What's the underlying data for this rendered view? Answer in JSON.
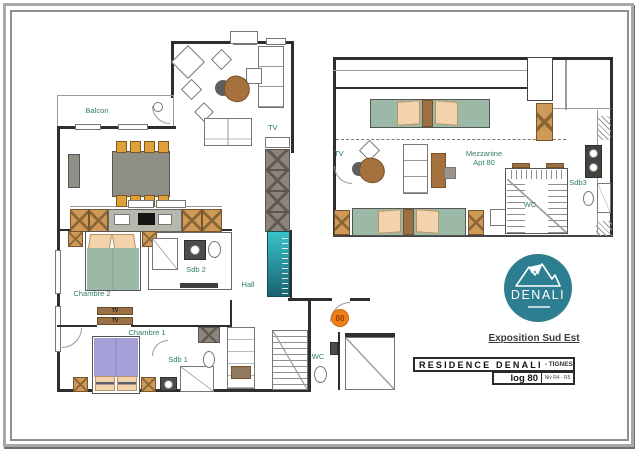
{
  "colors": {
    "label_green": "#2f7d62",
    "accent_orange": "#ee7f1b",
    "logo_teal": "#2c7e90",
    "stairs_teal_top": "#38c2c8",
    "stairs_teal_bottom": "#1b6272",
    "bed_green": "#9cb8a6",
    "bed_purple": "#a6a0d8",
    "wood_brown": "#a5713f",
    "cabinet_tan": "#cf9a58"
  },
  "main_plan": {
    "labels": {
      "balcon": "Balcon",
      "tv": "TV",
      "chambre_2": "Chambre 2",
      "sdb_2": "Sdb 2",
      "hall": "Hall",
      "chambre_1": "Chambre 1",
      "sdb_1": "Sdb 1",
      "wc": "WC",
      "tv_unit": "TV",
      "unit_badge": "80"
    }
  },
  "mezzanine_plan": {
    "labels": {
      "tv": "TV",
      "title_line_1": "Mezzanine",
      "title_line_2": "Apt 80",
      "wc": "WC",
      "sdb_3": "Sdb3"
    }
  },
  "branding": {
    "logo_text": "DENALI",
    "exposition": "Exposition Sud Est"
  },
  "title_block": {
    "residence": "RESIDENCE DENALI",
    "location": "- TIGNES",
    "unit": "log 80",
    "level": "Niv R4 - R5"
  }
}
